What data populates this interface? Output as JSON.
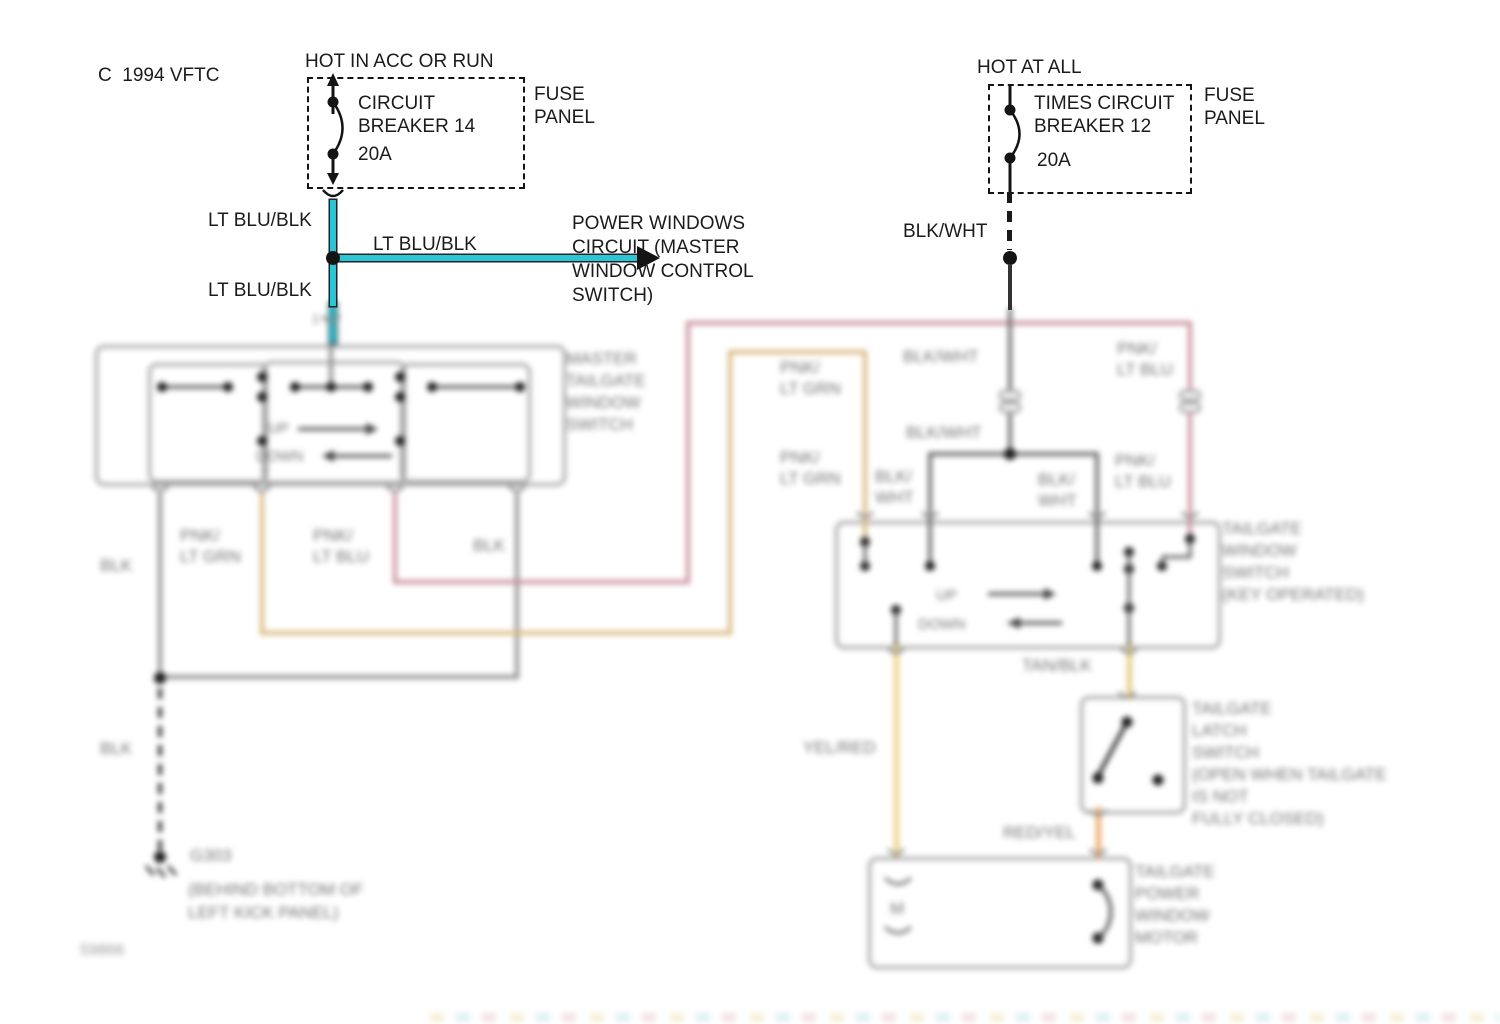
{
  "title_code": "C  1994 VFTC",
  "left_feed": {
    "hot_label": "HOT IN ACC OR RUN",
    "breaker_lines": [
      "CIRCUIT",
      "BREAKER 14"
    ],
    "rating": "20A",
    "panel_lines": [
      "FUSE",
      "PANEL"
    ]
  },
  "right_feed": {
    "hot_label": "HOT AT ALL",
    "breaker_lines": [
      "TIMES CIRCUIT",
      "BREAKER 12"
    ],
    "rating": "20A",
    "panel_lines": [
      "FUSE",
      "PANEL"
    ]
  },
  "branch_note_lines": [
    "POWER WINDOWS",
    "CIRCUIT (MASTER",
    "WINDOW CONTROL",
    "SWITCH)"
  ],
  "wire_labels": {
    "lt_blu_blk_upper": "LT BLU/BLK",
    "lt_blu_blk_branch": "LT BLU/BLK",
    "lt_blu_blk_lower": "LT BLU/BLK",
    "blk_wht_feed": "BLK/WHT",
    "pnk_lt_grn_1": [
      "PNK/",
      "LT GRN"
    ],
    "pnk_lt_blu_1": [
      "PNK/",
      "LT BLU"
    ],
    "blk_1": "BLK",
    "blk_2": "BLK",
    "blk_3": "BLK",
    "pnk_lt_grn_2": [
      "PNK/",
      "LT GRN"
    ],
    "pnk_lt_grn_3": [
      "PNK/",
      "LT GRN"
    ],
    "blk_wht_1": "BLK/WHT",
    "blk_wht_2": "BLK/WHT",
    "blk_wht_3": [
      "BLK/",
      "WHT"
    ],
    "blk_wht_4": [
      "BLK/",
      "WHT"
    ],
    "pnk_lt_blu_2": [
      "PNK/",
      "LT BLU"
    ],
    "pnk_lt_blu_3": [
      "PNK/",
      "LT BLU"
    ],
    "yel_red": "YEL/RED",
    "tan_blk": "TAN/BLK",
    "red_yel": "RED/YEL"
  },
  "components": {
    "master_switch": {
      "label_lines": [
        "MASTER",
        "TAILGATE",
        "WINDOW",
        "SWITCH"
      ],
      "up": "UP",
      "down": "DOWN",
      "connector_pin": "1"
    },
    "key_switch": {
      "label_lines": [
        "TAILGATE",
        "WINDOW",
        "SWITCH",
        "(KEY OPERATED)"
      ],
      "up": "UP",
      "down": "DOWN"
    },
    "latch_switch": {
      "label_lines": [
        "TAILGATE",
        "LATCH",
        "SWITCH",
        "(OPEN WHEN TAILGATE",
        "IS NOT",
        "FULLY CLOSED)"
      ]
    },
    "motor": {
      "label_lines": [
        "TAILGATE",
        "POWER",
        "WINDOW",
        "MOTOR"
      ],
      "symbol": "M"
    },
    "ground": {
      "id": "G303",
      "location_lines": [
        "(BEHIND BOTTOM OF",
        "LEFT KICK PANEL)"
      ]
    }
  },
  "watermark": "59866",
  "colors": {
    "lt_blu_blk": "#2bc5d6",
    "pnk_lt_grn": "#d8b77d",
    "pnk_lt_blu": "#c9909c",
    "yel_red": "#eed283",
    "tan_blk": "#e3cb80",
    "red_yel": "#efa969",
    "blk": "#8d8d8d",
    "blk_wht": "#6b6b6b"
  }
}
